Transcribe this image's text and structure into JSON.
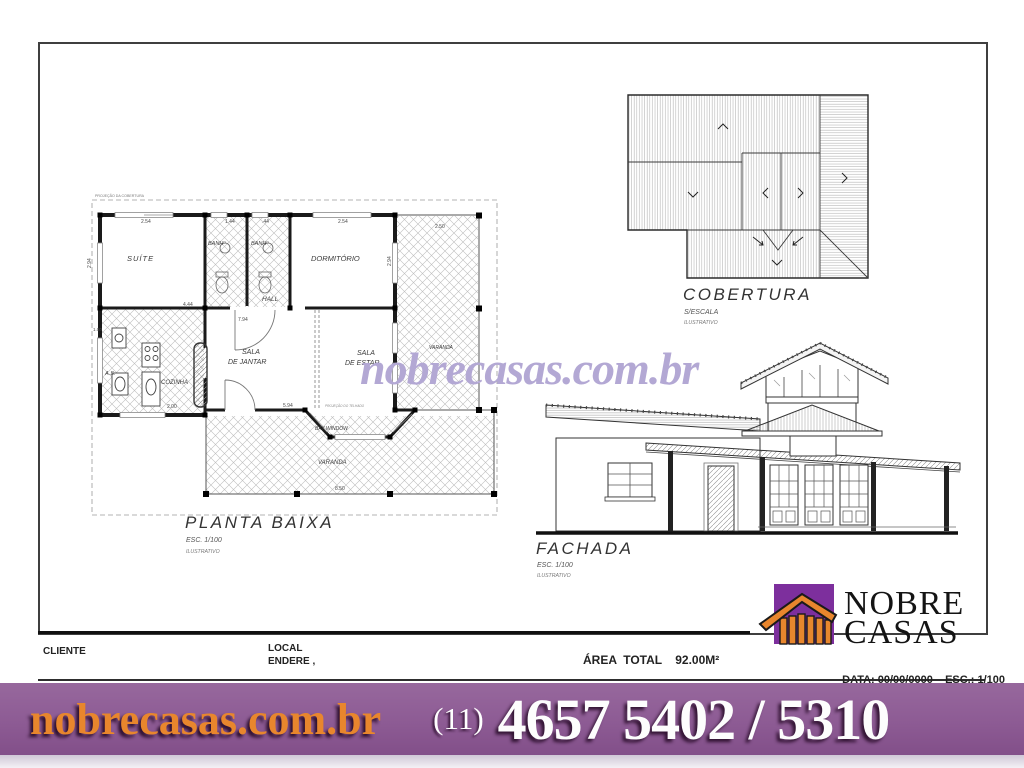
{
  "watermark": {
    "text": "nobrecasas.com.br"
  },
  "plan": {
    "title": "PLANTA  BAIXA",
    "scale_label": "ESC. 1/100",
    "note": "ILUSTRATIVO",
    "projection_note": "PROJEÇÃO DA COBERTURA",
    "rooms": {
      "suite": "SUÍTE",
      "banho1": "BANHº",
      "banho2": "BANHº",
      "dormitorio": "DORMITÓRIO",
      "hall": "HALL",
      "cozinha": "COZINHA",
      "area_servico": "A.S.",
      "jantar_l1": "SALA",
      "jantar_l2": "DE JANTAR",
      "estar_l1": "SALA",
      "estar_l2": "DE ESTAR",
      "bay_window": "BAY WINDOW",
      "varanda_bottom": "VARANDA",
      "varanda_right": "VARANDA",
      "roof_edge_note": "PROJEÇÃO DO TELHADO"
    },
    "dims": {
      "top_suite": "2.54",
      "top_banho1": "1.44",
      "top_banho2": ".44",
      "top_dorm": "2.54",
      "top_varanda": "2.50",
      "left_small": "1.00",
      "mid_suite": "4.44",
      "mid_total": "7.94",
      "bottom_kitchen": "2.00",
      "bottom_sala": "5.94",
      "bottom_varanda": "8.50",
      "side_left": "2.94",
      "side_right": "2.94"
    }
  },
  "roof": {
    "title": "COBERTURA",
    "scale_label": "S/ESCALA",
    "note": "ILUSTRATIVO"
  },
  "facade": {
    "title": "FACHADA",
    "scale_label": "ESC. 1/100",
    "note": "ILUSTRATIVO"
  },
  "logo": {
    "word1": "NOBRE",
    "word2": "CASAS"
  },
  "titleblock": {
    "cliente": "CLIENTE",
    "local": "LOCAL",
    "endereco": "ENDERE ,",
    "area": "ÁREA  TOTAL    92.00M²",
    "data": "DATA: 00/00/0000",
    "esc": "ESC.: 1/100"
  },
  "footer": {
    "site": "nobrecasas.com.br",
    "area_code": "(11)",
    "phone": "4657 5402 / 5310"
  },
  "colors": {
    "footer_purple": "#8d5b94",
    "logo_purple": "#7d2f9d",
    "logo_orange": "#e8862d",
    "watermark_purple": "#b3a8d4"
  }
}
